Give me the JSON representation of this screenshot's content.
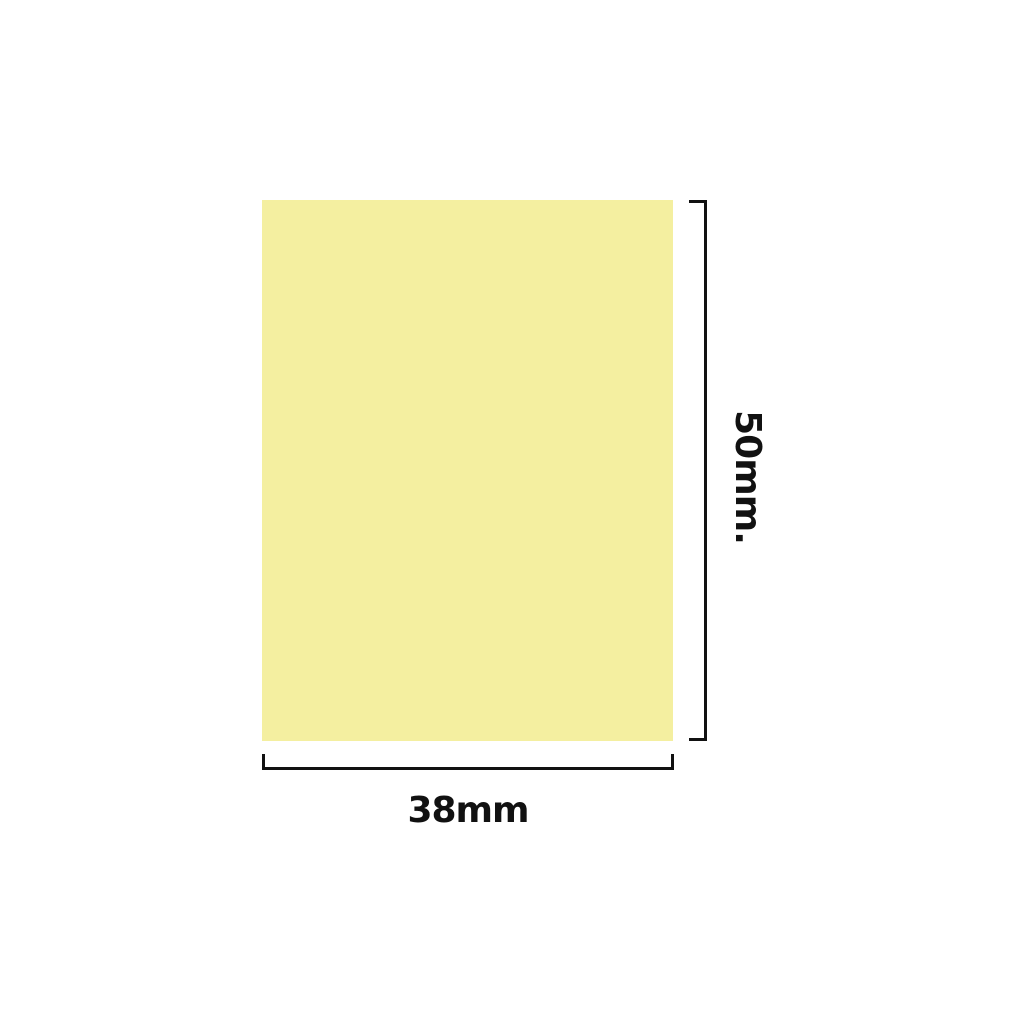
{
  "diagram": {
    "title": "label-size-diagram",
    "shape": {
      "kind": "rectangle",
      "fill_color": "#f4efa0"
    },
    "dimensions": {
      "height_label": "50mm.",
      "width_label": "38mm"
    },
    "annotation": {
      "line_color": "#111111",
      "text_color": "#111111",
      "background_color": "#ffffff"
    }
  }
}
